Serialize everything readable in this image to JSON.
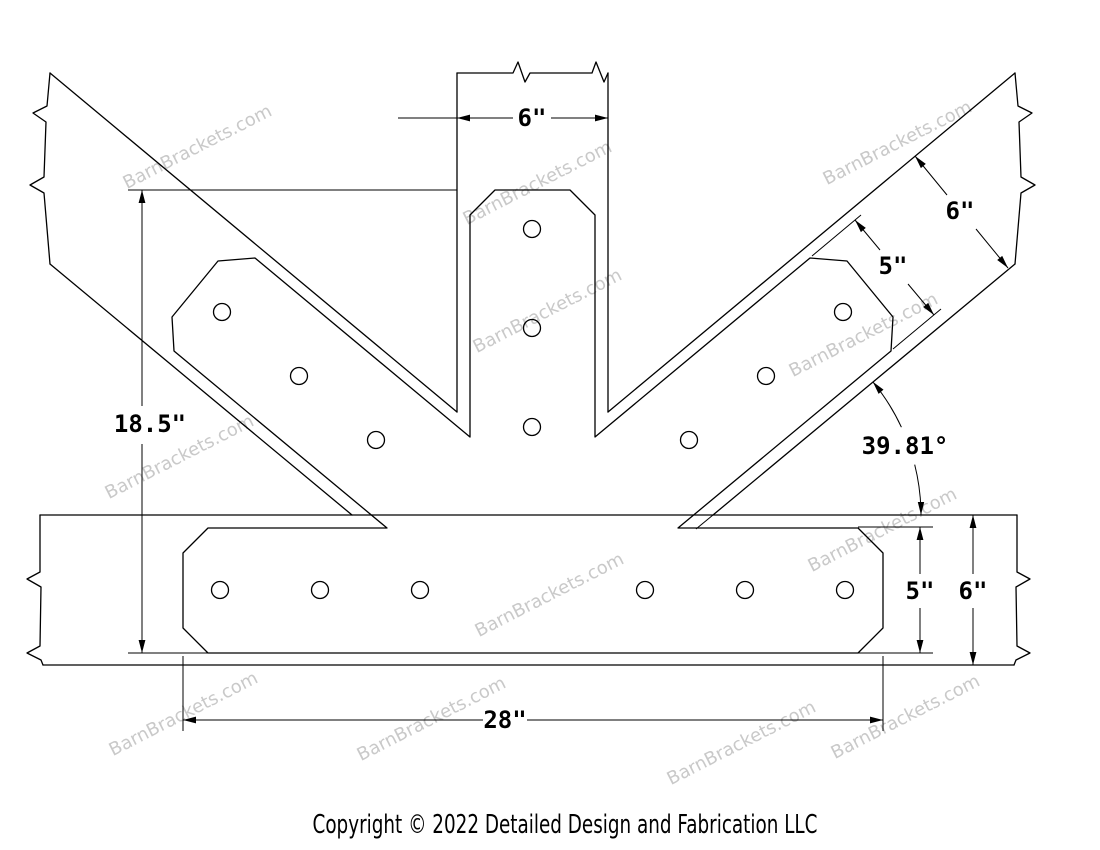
{
  "watermark": {
    "text": "BarnBrackets.com",
    "color": "#c9c9c9"
  },
  "footer": {
    "copyright": "Copyright © 2022 Detailed Design and Fabrication LLC"
  },
  "dimensions": {
    "post_width": "6\"",
    "overall_height": "18.5\"",
    "strut_plate_width": "5\"",
    "strut_timber_width": "6\"",
    "angle": "39.81°",
    "beam_plate_height": "5\"",
    "beam_timber_height": "6\"",
    "beam_plate_length": "28\""
  },
  "drawing": {
    "line_color": "#000000",
    "background": "#ffffff"
  }
}
